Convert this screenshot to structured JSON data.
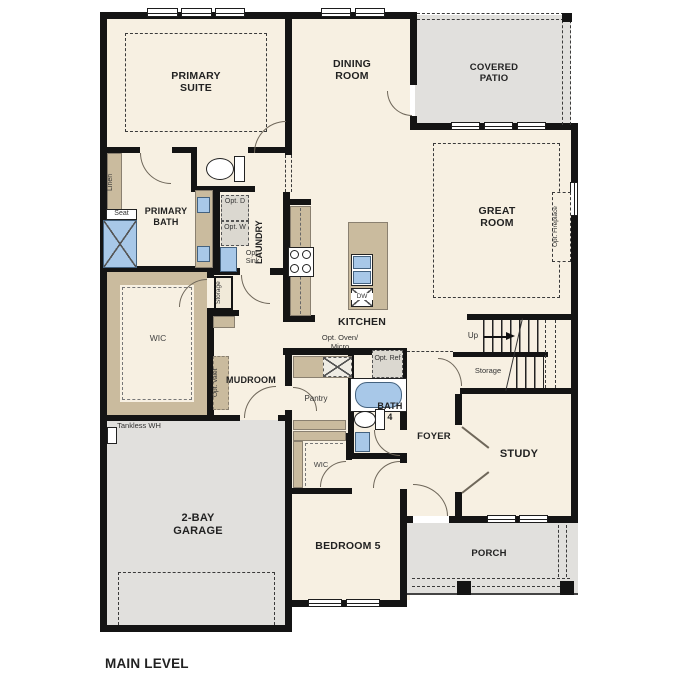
{
  "plan": {
    "title": "MAIN LEVEL",
    "colors": {
      "floor": "#f7f0e2",
      "outdoor_concrete": "#e1e0dd",
      "cabinet": "#cabb9e",
      "plumbing_fixture": "#a8c8e8",
      "wall": "#141414"
    },
    "rooms": {
      "primary_suite": "PRIMARY SUITE",
      "dining_room": "DINING ROOM",
      "covered_patio": "COVERED PATIO",
      "great_room": "GREAT ROOM",
      "primary_bath": "PRIMARY BATH",
      "laundry": "LAUNDRY",
      "kitchen": "KITCHEN",
      "wic_primary": "WIC",
      "mudroom": "MUDROOM",
      "pantry": "Pantry",
      "bath_4": "BATH 4",
      "foyer": "FOYER",
      "study": "STUDY",
      "garage": "2-BAY GARAGE",
      "bedroom_5": "BEDROOM 5",
      "wic_bedroom_5": "WIC",
      "porch": "PORCH"
    },
    "ann": {
      "linen": "Linen",
      "seat": "Seat",
      "opt_d": "Opt. D",
      "opt_w": "Opt. W",
      "opt_sink": "Opt. Sink",
      "storage_hall": "Storage",
      "opt_valet": "Opt. Valet",
      "opt_oven_micro": "Opt. Oven/ Micro",
      "opt_ref": "Opt. Ref",
      "dw": "DW",
      "up": "Up",
      "stair_storage": "Storage",
      "tankless_wh": "Tankless WH",
      "opt_fireplace": "Opt. Fireplace"
    }
  }
}
